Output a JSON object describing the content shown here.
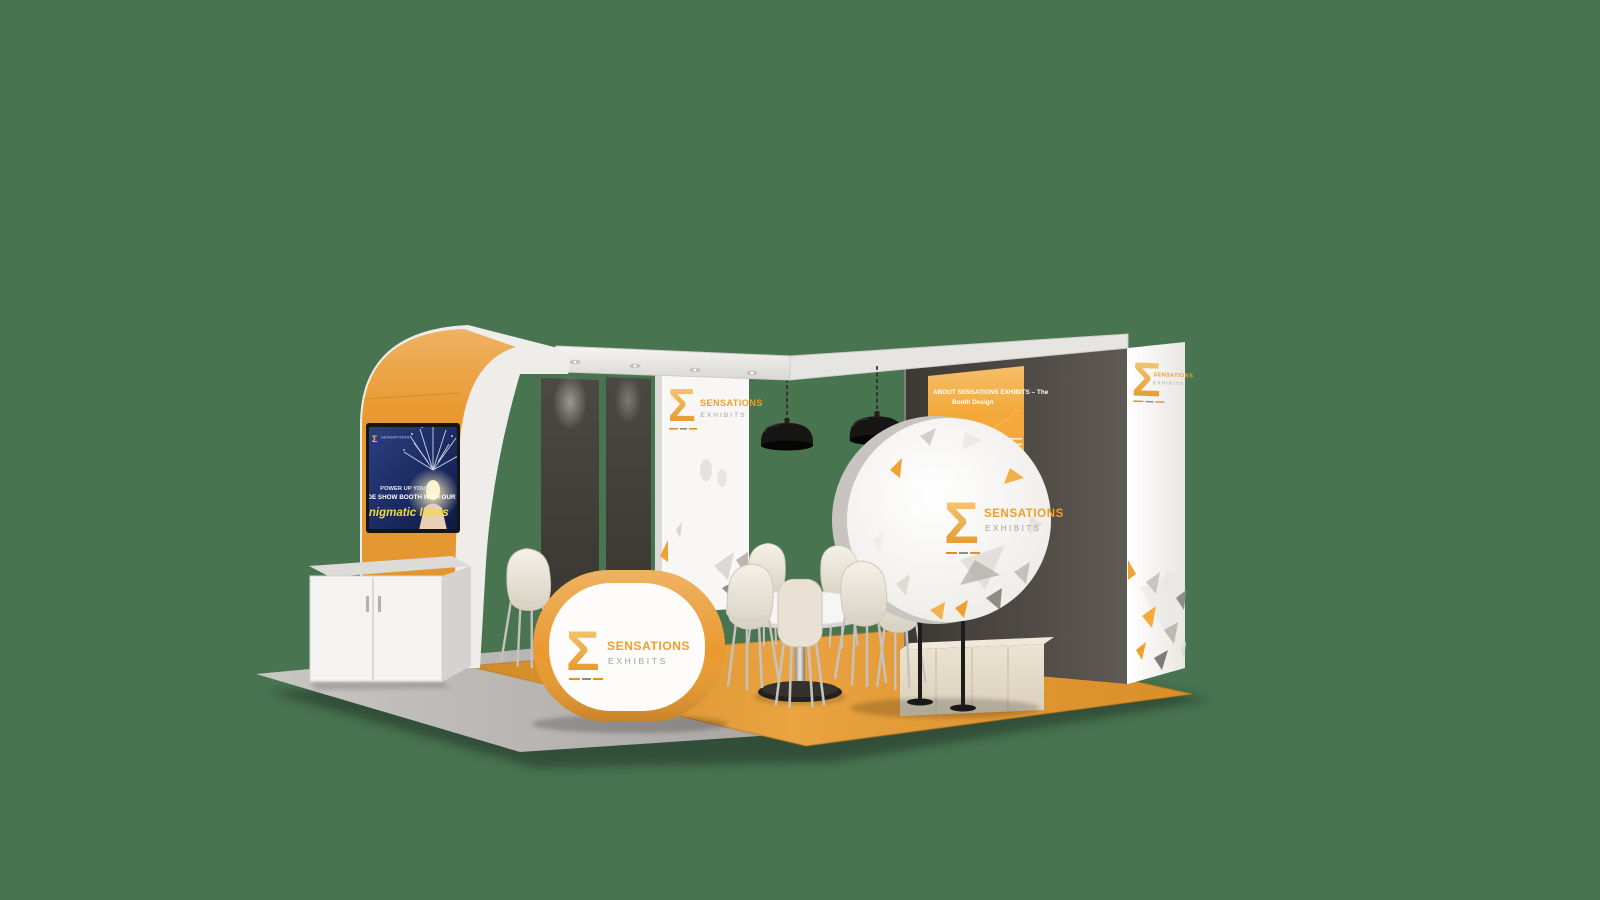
{
  "scene": {
    "description": "3D render of a Sensations Exhibits trade show booth on a plain green background"
  },
  "colors": {
    "background": "#497450",
    "brand_orange": "#e9992f",
    "carpet_orange": "#e8992c",
    "poster_orange": "#f3a93a",
    "dark_wall": "#55504a",
    "panel_white": "#f8f7f5",
    "screen_navy": "#16245b",
    "logo_gray": "#a39f99",
    "lamp_black": "#1c1a18"
  },
  "logo": {
    "sigma": "Σ",
    "name": "SENSATIONS",
    "subtitle": "EXHIBITS"
  },
  "tv_screen": {
    "brand_small": "SENSATIONS",
    "line1": "POWER UP YOUR",
    "line2": "TRADE SHOW BOOTH WITH OUR",
    "line3": "Enigmatic Ideas"
  },
  "poster": {
    "heading_line1": "ABOUT SENSATIONS EXHIBITS – The",
    "heading_line2": "Booth Design"
  }
}
